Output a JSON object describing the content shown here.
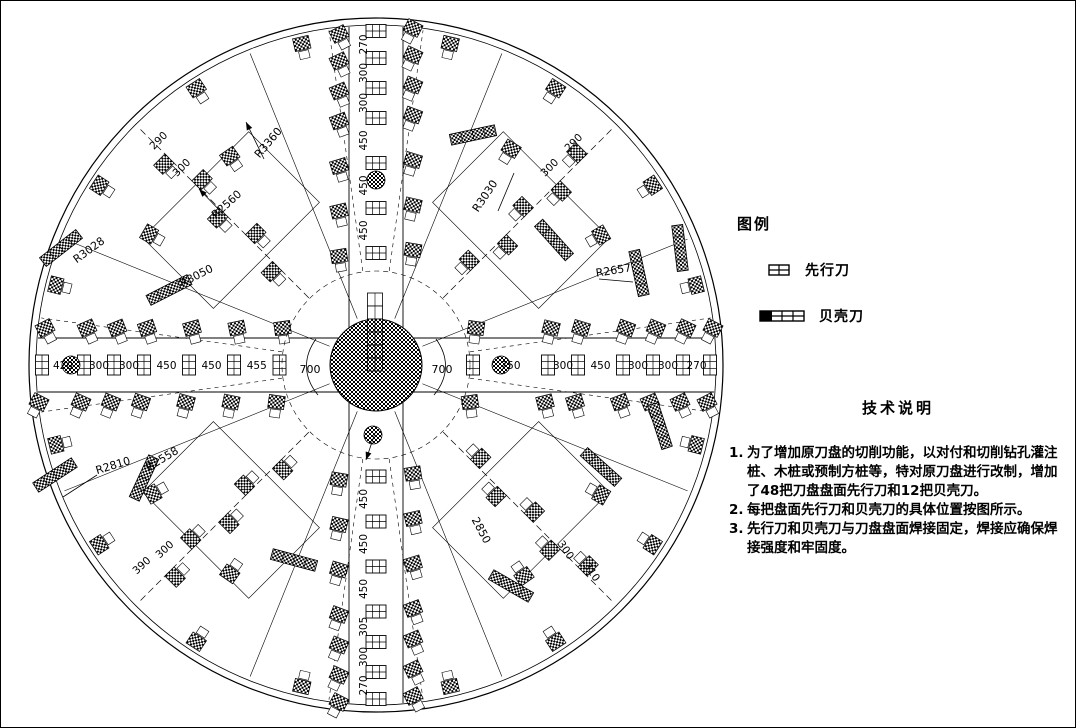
{
  "legend": {
    "title": "图例",
    "items": [
      {
        "icon": "pilot-cutter-icon",
        "label": "先行刀"
      },
      {
        "icon": "shell-cutter-icon",
        "label": "贝壳刀"
      }
    ]
  },
  "tech_notes": {
    "title": "技术说明",
    "nums": [
      "1.",
      "2.",
      "3."
    ],
    "items": [
      "为了增加原刀盘的切削功能，以对付和切削钻孔灌注桩、木桩或预制方桩等，特对原刀盘进行改制，增加了48把刀盘盘面先行刀和12把贝壳刀。",
      "每把盘面先行刀和贝壳刀的具体位置按图所示。",
      "先行刀和贝壳刀与刀盘盘面焊接固定，焊接应确保焊接强度和牢固度。"
    ]
  },
  "diagram": {
    "center": {
      "x": 375,
      "y": 364
    },
    "outer_radius": 347,
    "rim_inner_radius": 340,
    "hub_radius": 46,
    "hub_dashed_radius": 94,
    "band_half_width": 27,
    "scale_px_per_mm": 0.1,
    "rows": {
      "left": {
        "dims_rim_to_center": [
          "420",
          "300",
          "300",
          "450",
          "450",
          "455"
        ],
        "center_gap_dim": "700"
      },
      "right": {
        "dims_rim_to_center": [
          "270",
          "300",
          "300",
          "450",
          "300",
          "750"
        ],
        "center_gap_dim": "700"
      },
      "top": {
        "dims_rim_to_center": [
          "270",
          "300",
          "300",
          "450",
          "450",
          "450"
        ]
      },
      "bottom": {
        "dims_rim_to_center": [
          "270",
          "300",
          "305",
          "450",
          "450",
          "450"
        ]
      }
    },
    "circle_cutters": [
      {
        "dx": -305,
        "dy": 0
      },
      {
        "dx": 125,
        "dy": 0
      },
      {
        "dx": 0,
        "dy": -185
      },
      {
        "dx": -3,
        "dy": 70
      }
    ],
    "beam": {
      "x": 374,
      "top": 292,
      "bottom": 368,
      "seg_h": 13,
      "w": 15
    },
    "sector_line_angles": [
      22,
      68,
      112,
      158,
      202,
      248,
      292,
      338
    ],
    "diagonal_dashed_angles": [
      45,
      135,
      225,
      315
    ],
    "axis_dashed_angles": [
      8,
      82,
      98,
      172,
      188,
      262,
      278,
      352
    ],
    "diagonal_chains": [
      {
        "angle": 45,
        "radii": [
          140,
          178,
          216,
          254,
          292
        ]
      },
      {
        "angle": 135,
        "radii": [
          140,
          178,
          216,
          254,
          292
        ]
      },
      {
        "angle": 225,
        "radii": [
          140,
          178,
          216,
          254,
          292
        ]
      },
      {
        "angle": 315,
        "radii": [
          140,
          178,
          216,
          254,
          292
        ]
      }
    ],
    "rim_blocks": {
      "r": 330,
      "angles": [
        14,
        33,
        57,
        77,
        103,
        123,
        147,
        166,
        194,
        213,
        237,
        257,
        283,
        303,
        327,
        346
      ]
    },
    "scatter_blocks": [
      {
        "a": 58,
        "r": 255
      },
      {
        "a": 30,
        "r": 260
      },
      {
        "a": 125,
        "r": 255
      },
      {
        "a": 150,
        "r": 262
      },
      {
        "a": 210,
        "r": 258
      },
      {
        "a": 235,
        "r": 255
      },
      {
        "a": 305,
        "r": 258
      },
      {
        "a": 330,
        "r": 260
      }
    ],
    "plates": [
      {
        "a": 45,
        "r": 205,
        "w": 150,
        "h": 100
      },
      {
        "a": 135,
        "r": 205,
        "w": 150,
        "h": 100
      },
      {
        "a": 225,
        "r": 205,
        "w": 150,
        "h": 100
      },
      {
        "a": 315,
        "r": 205,
        "w": 150,
        "h": 100
      }
    ],
    "shell_bars": [
      {
        "x": 60,
        "y": 247,
        "rot": -38
      },
      {
        "x": 168,
        "y": 289,
        "rot": -27
      },
      {
        "x": 472,
        "y": 134,
        "rot": -12
      },
      {
        "x": 553,
        "y": 239,
        "rot": 48
      },
      {
        "x": 679,
        "y": 247,
        "rot": 83
      },
      {
        "x": 638,
        "y": 272,
        "rot": 78
      },
      {
        "x": 143,
        "y": 477,
        "rot": -65
      },
      {
        "x": 54,
        "y": 474,
        "rot": -33
      },
      {
        "x": 600,
        "y": 466,
        "rot": 42
      },
      {
        "x": 659,
        "y": 425,
        "rot": 72
      },
      {
        "x": 293,
        "y": 559,
        "rot": 15
      },
      {
        "x": 510,
        "y": 585,
        "rot": 30
      }
    ],
    "radial_labels": [
      {
        "text": "R3360",
        "x": 270,
        "y": 144,
        "rot": -50
      },
      {
        "text": "R2560",
        "x": 228,
        "y": 206,
        "rot": -42
      },
      {
        "text": "R3028",
        "x": 90,
        "y": 252,
        "rot": -36
      },
      {
        "text": "R3050",
        "x": 197,
        "y": 278,
        "rot": -27
      },
      {
        "text": "R3030",
        "x": 487,
        "y": 197,
        "rot": -56
      },
      {
        "text": "R2657",
        "x": 613,
        "y": 273,
        "rot": -9
      },
      {
        "text": "R2810",
        "x": 113,
        "y": 468,
        "rot": -17
      },
      {
        "text": "R2558",
        "x": 163,
        "y": 461,
        "rot": -31
      },
      {
        "text": "2850",
        "x": 477,
        "y": 531,
        "rot": 62
      }
    ],
    "quadrant_dims": [
      {
        "text": "290",
        "x": 160,
        "y": 142,
        "rot": -45
      },
      {
        "text": "300",
        "x": 183,
        "y": 169,
        "rot": -45
      },
      {
        "text": "300",
        "x": 551,
        "y": 169,
        "rot": -45
      },
      {
        "text": "290",
        "x": 575,
        "y": 144,
        "rot": -45
      },
      {
        "text": "390",
        "x": 143,
        "y": 567,
        "rot": -43
      },
      {
        "text": "300",
        "x": 166,
        "y": 551,
        "rot": -43
      },
      {
        "text": "300",
        "x": 562,
        "y": 551,
        "rot": 55
      },
      {
        "text": "310",
        "x": 588,
        "y": 573,
        "rot": 55
      }
    ],
    "arrows": [
      {
        "x1": 263,
        "y1": 158,
        "x2": 245,
        "y2": 121,
        "head": true
      },
      {
        "x1": 224,
        "y1": 215,
        "x2": 198,
        "y2": 188,
        "head": true
      },
      {
        "x1": 374,
        "y1": 432,
        "x2": 365,
        "y2": 459,
        "head": true
      },
      {
        "x1": 497,
        "y1": 210,
        "x2": 513,
        "y2": 172,
        "head": false
      },
      {
        "x1": 96,
        "y1": 474,
        "x2": 62,
        "y2": 496,
        "head": false
      },
      {
        "x1": 598,
        "y1": 278,
        "x2": 632,
        "y2": 281,
        "head": false
      }
    ]
  }
}
